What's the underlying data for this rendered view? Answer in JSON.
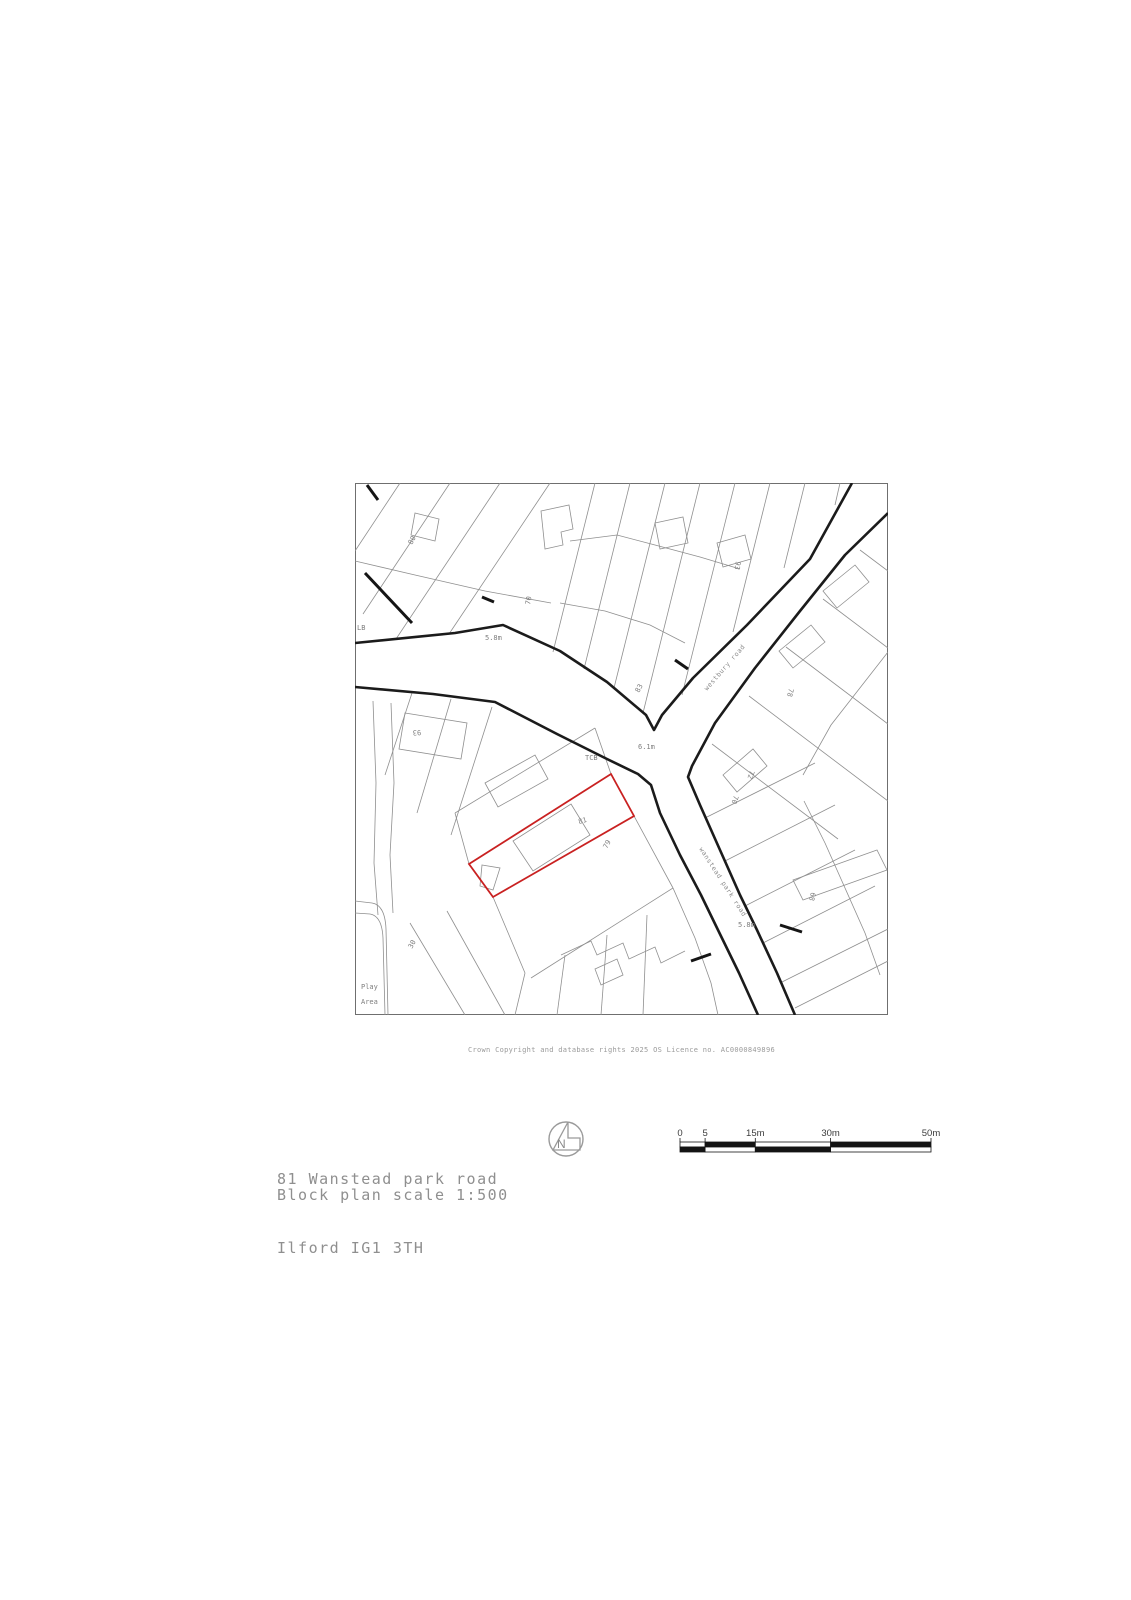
{
  "page": {
    "address_line1": "81 Wanstead park road",
    "address_line2": "Ilford IG1 3TH",
    "scale_text": "Block plan scale 1:500",
    "copyright": "Crown Copyright and database rights 2025 OS Licence no. AC0000849896",
    "north_label": "N"
  },
  "colors": {
    "plot_red": "#c92121",
    "road_black": "#1b1b1b",
    "parcel_gray": "#8f8f8f",
    "text_gray": "#8f8f8f"
  },
  "scale_bar": {
    "total_m": 50,
    "bar_px": 251,
    "labels": [
      {
        "text": "0",
        "m": 0
      },
      {
        "text": "5",
        "m": 5
      },
      {
        "text": "15m",
        "m": 15
      },
      {
        "text": "30m",
        "m": 30
      },
      {
        "text": "50m",
        "m": 50
      }
    ],
    "segments_m": [
      [
        0,
        5
      ],
      [
        5,
        15
      ],
      [
        15,
        30
      ],
      [
        30,
        50
      ]
    ]
  },
  "map": {
    "labels": [
      {
        "text": "LB",
        "x": 2,
        "y": 147,
        "rot": 0
      },
      {
        "text": "5.8m",
        "x": 130,
        "y": 157,
        "rot": 0
      },
      {
        "text": "80",
        "x": 57,
        "y": 62,
        "rot": -62
      },
      {
        "text": "70",
        "x": 175,
        "y": 122,
        "rot": -80
      },
      {
        "text": "93",
        "x": 381,
        "y": 78,
        "rot": 100
      },
      {
        "text": "83",
        "x": 284,
        "y": 210,
        "rot": -62
      },
      {
        "text": "westbury road",
        "x": 352,
        "y": 208,
        "rot": -49,
        "road": true
      },
      {
        "text": "TCB",
        "x": 230,
        "y": 277,
        "rot": 0
      },
      {
        "text": "6.1m",
        "x": 283,
        "y": 266,
        "rot": 0
      },
      {
        "text": "93",
        "x": 66,
        "y": 247,
        "rot": 176
      },
      {
        "text": "78",
        "x": 434,
        "y": 205,
        "rot": 103
      },
      {
        "text": "72",
        "x": 395,
        "y": 287,
        "rot": 108
      },
      {
        "text": "70",
        "x": 379,
        "y": 312,
        "rot": 108
      },
      {
        "text": "81",
        "x": 224,
        "y": 341,
        "rot": -15
      },
      {
        "text": "79",
        "x": 252,
        "y": 366,
        "rot": -62
      },
      {
        "text": "68",
        "x": 456,
        "y": 409,
        "rot": 103
      },
      {
        "text": "wanstead park road",
        "x": 344,
        "y": 366,
        "rot": 57,
        "road": true
      },
      {
        "text": "5.8m",
        "x": 383,
        "y": 444,
        "rot": 0
      },
      {
        "text": "30",
        "x": 57,
        "y": 466,
        "rot": -62
      },
      {
        "text": "Play",
        "x": 6,
        "y": 506,
        "rot": 0
      },
      {
        "text": "Area",
        "x": 6,
        "y": 521,
        "rot": 0
      }
    ],
    "roads_thick": [
      "M 0,160 L 100,150 148,142 205,168 252,199 291,232 299,247 307,232 338,195 392,142 455,76 497,0",
      "M 0,204 L 78,211 140,219 202,251 252,276 283,291 296,302 305,330 325,372 346,412 363,447 384,490 403,532",
      "M 533,30 L 490,72 445,128 400,185 360,240 337,283 333,294 345,322 365,367 385,412 402,447 422,490 440,532"
    ],
    "accents": [
      "M 12,2 L 23,17",
      "M 10,90 L 57,140",
      "M 127,114 L 139,119",
      "M 320,177 L 333,186",
      "M 425,442 L 447,449",
      "M 336,478 L 356,471"
    ],
    "parcels_thin": [
      "M 45,0 L 0,68",
      "M 95,0 L 8,131",
      "M 145,0 L 41,156",
      "M 195,0 L 94,151",
      "M 0,78 L 60,92 130,108 196,120",
      "M 60,30 L 84,36 80,58 56,52 Z",
      "M 240,0 L 198,169",
      "M 275,0 L 229,186",
      "M 310,0 L 259,205",
      "M 345,0 L 288,230",
      "M 380,0 L 327,212",
      "M 415,0 L 378,149",
      "M 450,0 L 429,85",
      "M 485,0 L 480,22",
      "M 205,120 L 250,128 295,142 330,160",
      "M 215,58 L 262,52 300,62 345,74 385,86",
      "M 186,28 L 214,22 218,46 206,49 208,62 190,66 Z",
      "M 300,40 L 328,34 333,60 305,66 Z",
      "M 362,60 L 390,52 396,76 368,84 Z",
      "M 533,169 L 476,242 448,292",
      "M 449,318 L 470,360 490,405 510,450 525,492",
      "M 505,67 L 533,88",
      "M 468,116 L 533,165",
      "M 431,164 L 533,241",
      "M 394,213 L 533,318",
      "M 357,261 L 483,356",
      "M 350,335 L 460,280",
      "M 370,378 L 480,322",
      "M 390,423 L 500,367",
      "M 408,460 L 520,403",
      "M 425,500 L 533,446",
      "M 438,397 L 522,367 532,387 448,417 Z",
      "M 468,108 L 500,82 514,99 482,125 Z",
      "M 424,168 L 456,142 470,159 438,185 Z",
      "M 368,292 L 398,266 412,283 382,309 Z",
      "M 440,525 L 533,478",
      "M 18,218 L 21,300 19,380 23,432",
      "M 36,220 L 39,300 35,372 38,430",
      "M 0,418 L 17,420 Q 30,422 31,446 L 33,532",
      "M 0,430 L 15,431 Q 27,433 28,455 L 30,532",
      "M 57,210 L 30,292",
      "M 96,216 L 62,330",
      "M 137,224 L 96,352",
      "M 50,230 L 112,240 106,276 44,266 Z",
      "M 100,330 L 240,245",
      "M 100,330 L 114,381",
      "M 240,245 L 256,291",
      "M 130,300 L 180,272 193,296 143,324 Z",
      "M 216,321 L 235,352 178,388 158,358 Z",
      "M 127,382 L 145,385 138,407 125,403 Z",
      "M 279,333 L 318,405",
      "M 318,405 L 176,495",
      "M 138,414 L 170,490",
      "M 318,405 L 340,455 356,500 363,532",
      "M 170,490 L 160,532",
      "M 210,472 L 202,532",
      "M 252,452 L 246,532",
      "M 292,432 L 288,532",
      "M 206,472 L 236,458 242,472 268,460 274,476 300,464 306,480 330,468",
      "M 240,486 L 262,476 268,492 246,502 Z",
      "M 55,440 L 110,532",
      "M 92,428 L 150,532"
    ],
    "red_plot": "M 256,291 L 279,333 138,414 114,381 Z"
  }
}
